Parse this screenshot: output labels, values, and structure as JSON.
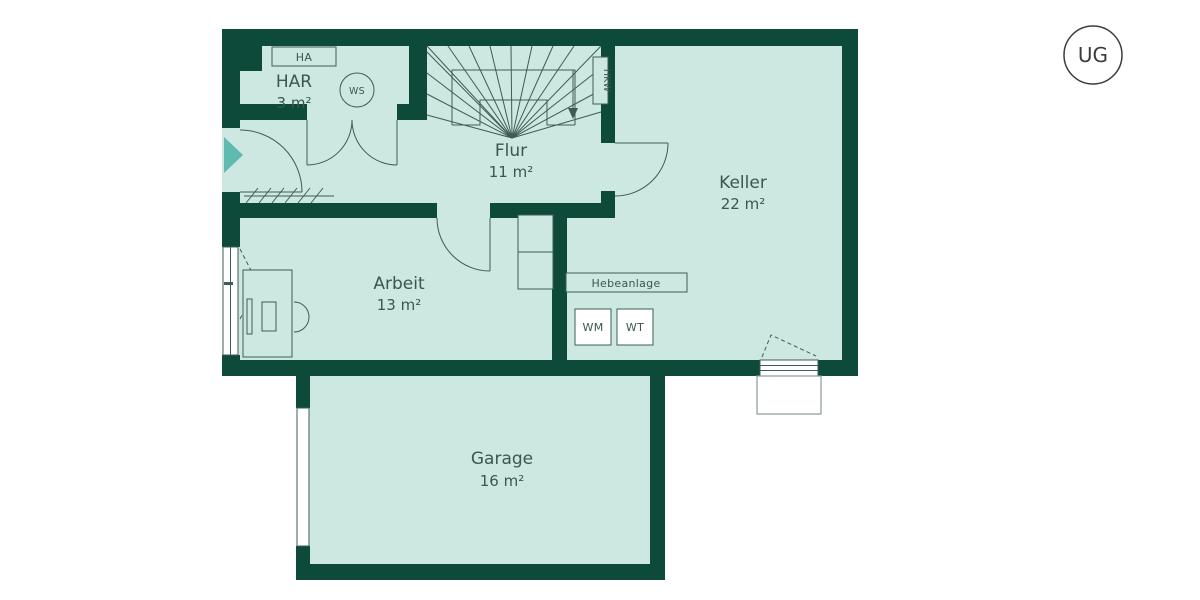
{
  "floor_badge": {
    "label": "UG"
  },
  "rooms": {
    "har": {
      "name": "HAR",
      "area": "3 m²"
    },
    "flur": {
      "name": "Flur",
      "area": "11 m²"
    },
    "keller": {
      "name": "Keller",
      "area": "22 m²"
    },
    "arbeit": {
      "name": "Arbeit",
      "area": "13 m²"
    },
    "garage": {
      "name": "Garage",
      "area": "16 m²"
    }
  },
  "equipment": {
    "ha": "HA",
    "ws": "WS",
    "hkw": "HKW",
    "hebeanlage": "Hebeanlage",
    "wm": "WM",
    "wt": "WT"
  },
  "colors": {
    "wall": "#0e4a39",
    "floor": "#cde7e1",
    "entrance_accent": "#5fbab0",
    "line": "#3e5c57",
    "text": "#3a5751"
  }
}
